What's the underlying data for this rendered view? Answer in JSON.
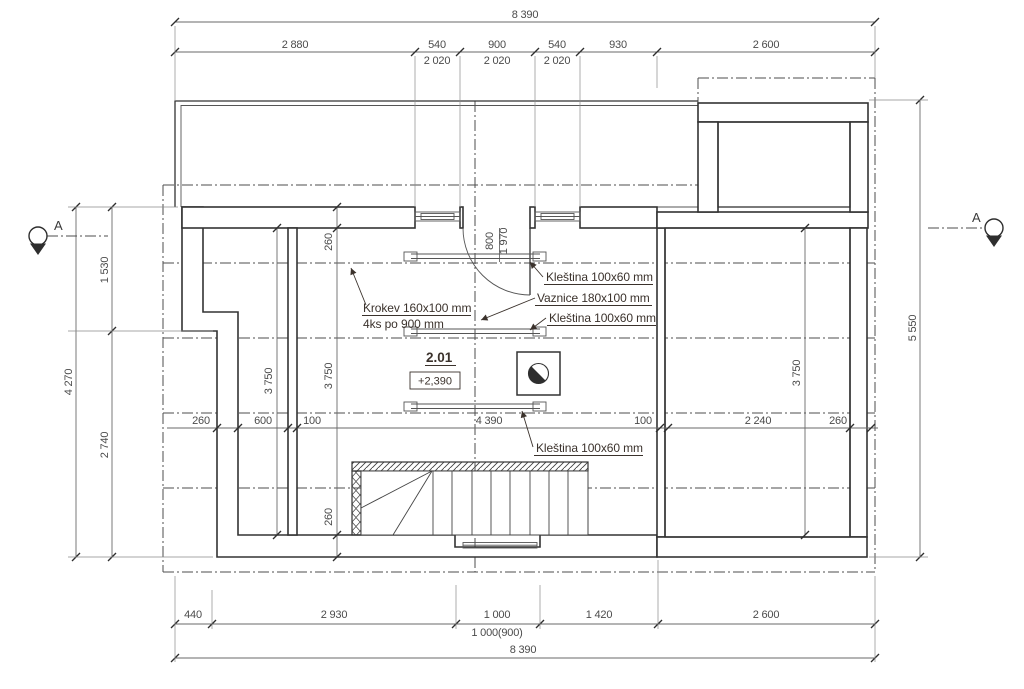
{
  "drawing": {
    "room": {
      "number": "2.01",
      "level": "+2,390"
    },
    "section": {
      "left_label": "A",
      "right_label": "A"
    },
    "annotations": {
      "klestina_top": "Kleština 100x60 mm",
      "vaznice": "Vaznice 180x100 mm",
      "klestina_mid": "Kleština 100x60 mm",
      "krokev_line1": "Krokev 160x100 mm",
      "krokev_line2": "4ks po 900 mm",
      "klestina_bottom": "Kleština 100x60 mm"
    },
    "dimensions": {
      "top_total": "8 390",
      "top_chain": [
        "2 880",
        "540",
        "900",
        "540",
        "930",
        "2 600"
      ],
      "sill_heights": [
        "2 020",
        "2 020",
        "2 020"
      ],
      "left": {
        "upper": "1 530",
        "lower": "2 740",
        "total": "4 270"
      },
      "right_total": "5 550",
      "bottom_chain": [
        "440",
        "2 930",
        "1 000",
        "1 420",
        "2 600"
      ],
      "bottom_opening": "1 000(900)",
      "bottom_total": "8 390",
      "interior_horizontal": [
        "260",
        "600",
        "100",
        "4 390",
        "100",
        "2 240",
        "260"
      ],
      "interior_vertical": {
        "wall_top": "260",
        "left_room": "3 750",
        "mid_room": "3 750",
        "right_room": "3 750",
        "wall_bottom": "260"
      },
      "door": {
        "width": "800",
        "height": "1 970"
      }
    }
  }
}
